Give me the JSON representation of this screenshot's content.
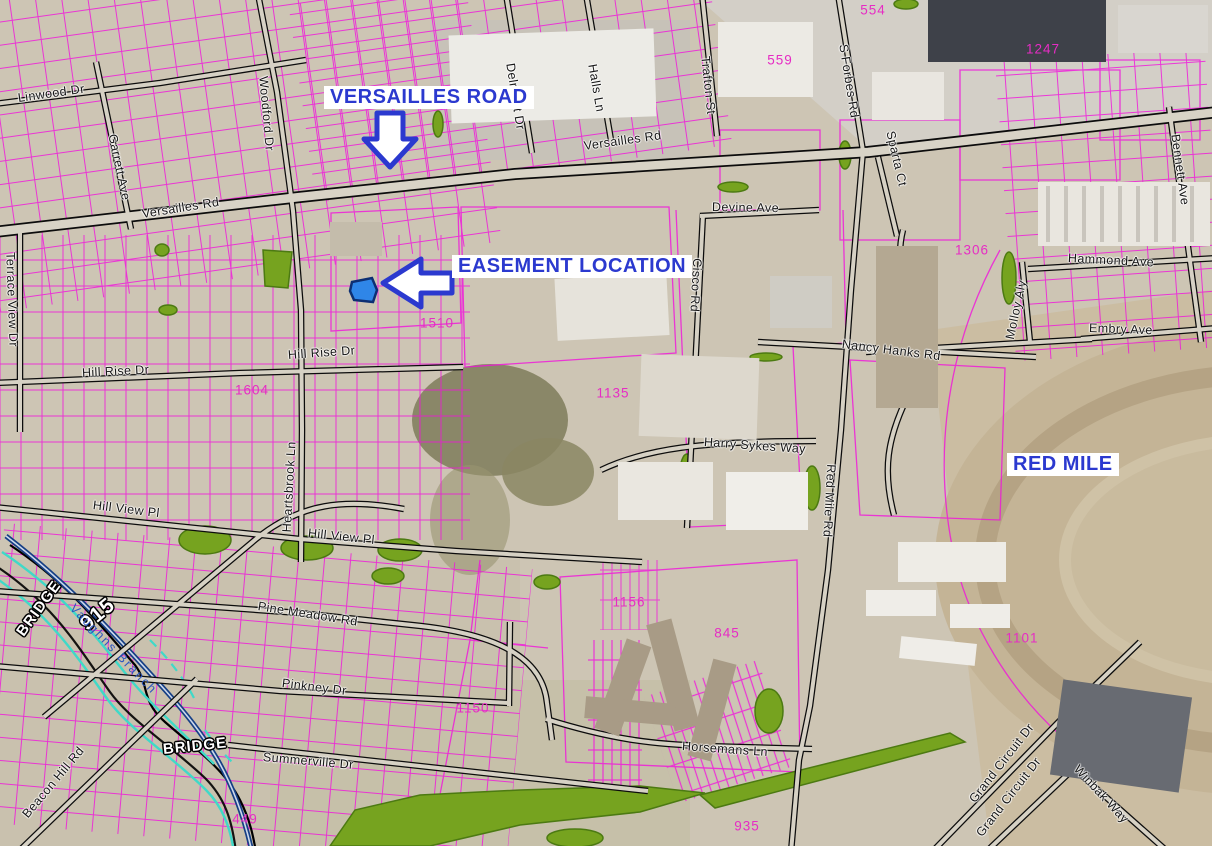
{
  "map": {
    "title": "Easement location exhibit map - Versailles Rd / Red Mile area",
    "colors": {
      "callout_blue": "#2b39cf",
      "parcel_line": "#f211dd",
      "parcel_number": "#e62cc4",
      "green": "#76a31f",
      "stream_blue": "#2b55c0",
      "flood_cyan": "#3fd9c8",
      "easement_blue": "#2f86e8"
    },
    "callouts": [
      {
        "id": "versailles-road-callout",
        "text": "VERSAILLES ROAD",
        "x": 324,
        "y": 86,
        "arrow": "down"
      },
      {
        "id": "easement-location-callout",
        "text": "EASEMENT LOCATION",
        "x": 452,
        "y": 255,
        "arrow": "left"
      },
      {
        "id": "red-mile-callout",
        "text": "RED MILE",
        "x": 1007,
        "y": 453,
        "arrow": "none"
      }
    ],
    "street_labels": [
      {
        "text": "Linwood Dr",
        "x": 18,
        "y": 92,
        "rot": -8
      },
      {
        "text": "Garrett Ave",
        "x": 112,
        "y": 128,
        "rot": 78
      },
      {
        "text": "Woodford Dr",
        "x": 263,
        "y": 70,
        "rot": 85
      },
      {
        "text": "Versailles Rd",
        "x": 142,
        "y": 208,
        "rot": -9
      },
      {
        "text": "Versailles Rd",
        "x": 584,
        "y": 140,
        "rot": -8
      },
      {
        "text": "Delmont Dr",
        "x": 510,
        "y": 57,
        "rot": 81
      },
      {
        "text": "Halls Ln",
        "x": 592,
        "y": 58,
        "rot": 80
      },
      {
        "text": "Trafton St",
        "x": 705,
        "y": 50,
        "rot": 84
      },
      {
        "text": "S Forbes Rd",
        "x": 843,
        "y": 38,
        "rot": 81
      },
      {
        "text": "Sparta Ct",
        "x": 890,
        "y": 125,
        "rot": 77
      },
      {
        "text": "Bennett Ave",
        "x": 1175,
        "y": 128,
        "rot": 82
      },
      {
        "text": "Devine Ave",
        "x": 712,
        "y": 201,
        "rot": 1
      },
      {
        "text": "Hammond Ave",
        "x": 1068,
        "y": 252,
        "rot": 3
      },
      {
        "text": "Molloy Aly",
        "x": 1010,
        "y": 333,
        "rot": -78
      },
      {
        "text": "Embry Ave",
        "x": 1089,
        "y": 322,
        "rot": 2
      },
      {
        "text": "Terrace View Dr",
        "x": 10,
        "y": 246,
        "rot": 88
      },
      {
        "text": "Hill Rise Dr",
        "x": 82,
        "y": 367,
        "rot": -3
      },
      {
        "text": "Hill Rise Dr",
        "x": 288,
        "y": 349,
        "rot": -4
      },
      {
        "text": "Cisco Rd",
        "x": 697,
        "y": 252,
        "rot": 93
      },
      {
        "text": "Nancy Hanks Rd",
        "x": 842,
        "y": 338,
        "rot": 7
      },
      {
        "text": "Harry Sykes Way",
        "x": 704,
        "y": 436,
        "rot": 4
      },
      {
        "text": "Heartsbrook Ln",
        "x": 287,
        "y": 526,
        "rot": -87
      },
      {
        "text": "Hill View Pl",
        "x": 93,
        "y": 499,
        "rot": 7
      },
      {
        "text": "Hill View Pl",
        "x": 308,
        "y": 527,
        "rot": 6
      },
      {
        "text": "Red Mile Rd",
        "x": 831,
        "y": 458,
        "rot": 93
      },
      {
        "text": "Pine Meadow Rd",
        "x": 258,
        "y": 600,
        "rot": 9
      },
      {
        "text": "Pinkney Dr",
        "x": 282,
        "y": 677,
        "rot": 7
      },
      {
        "text": "Summerville Dr",
        "x": 263,
        "y": 751,
        "rot": 5
      },
      {
        "text": "Beacon Hill Rd",
        "x": 25,
        "y": 810,
        "rot": -50
      },
      {
        "text": "Horsemans Ln",
        "x": 682,
        "y": 740,
        "rot": 4
      },
      {
        "text": "Grand Circuit Dr",
        "x": 972,
        "y": 795,
        "rot": -52
      },
      {
        "text": "Grand Circuit Dr",
        "x": 979,
        "y": 829,
        "rot": -52
      },
      {
        "text": "Winbak Way",
        "x": 1076,
        "y": 761,
        "rot": 47
      }
    ],
    "parcel_numbers": [
      {
        "text": "559",
        "x": 780,
        "y": 60
      },
      {
        "text": "554",
        "x": 873,
        "y": 10
      },
      {
        "text": "1247",
        "x": 1043,
        "y": 49
      },
      {
        "text": "1306",
        "x": 972,
        "y": 250
      },
      {
        "text": "1510",
        "x": 437,
        "y": 323
      },
      {
        "text": "1604",
        "x": 252,
        "y": 390
      },
      {
        "text": "1135",
        "x": 613,
        "y": 393
      },
      {
        "text": "1156",
        "x": 629,
        "y": 602
      },
      {
        "text": "845",
        "x": 727,
        "y": 633
      },
      {
        "text": "1101",
        "x": 1022,
        "y": 638
      },
      {
        "text": "1150",
        "x": 473,
        "y": 708
      },
      {
        "text": "449",
        "x": 245,
        "y": 819
      },
      {
        "text": "935",
        "x": 747,
        "y": 826
      }
    ],
    "bridge_labels": [
      {
        "text": "BRIDGE",
        "x": 20,
        "y": 627,
        "rot": -54,
        "size": 15
      },
      {
        "text": "915",
        "x": 83,
        "y": 616,
        "rot": -40,
        "size": 21
      },
      {
        "text": "BRIDGE",
        "x": 163,
        "y": 742,
        "rot": -6,
        "size": 15
      }
    ],
    "water_labels": [
      {
        "text": "Vaughns Branch",
        "x": 72,
        "y": 600,
        "rot": 46
      }
    ]
  }
}
